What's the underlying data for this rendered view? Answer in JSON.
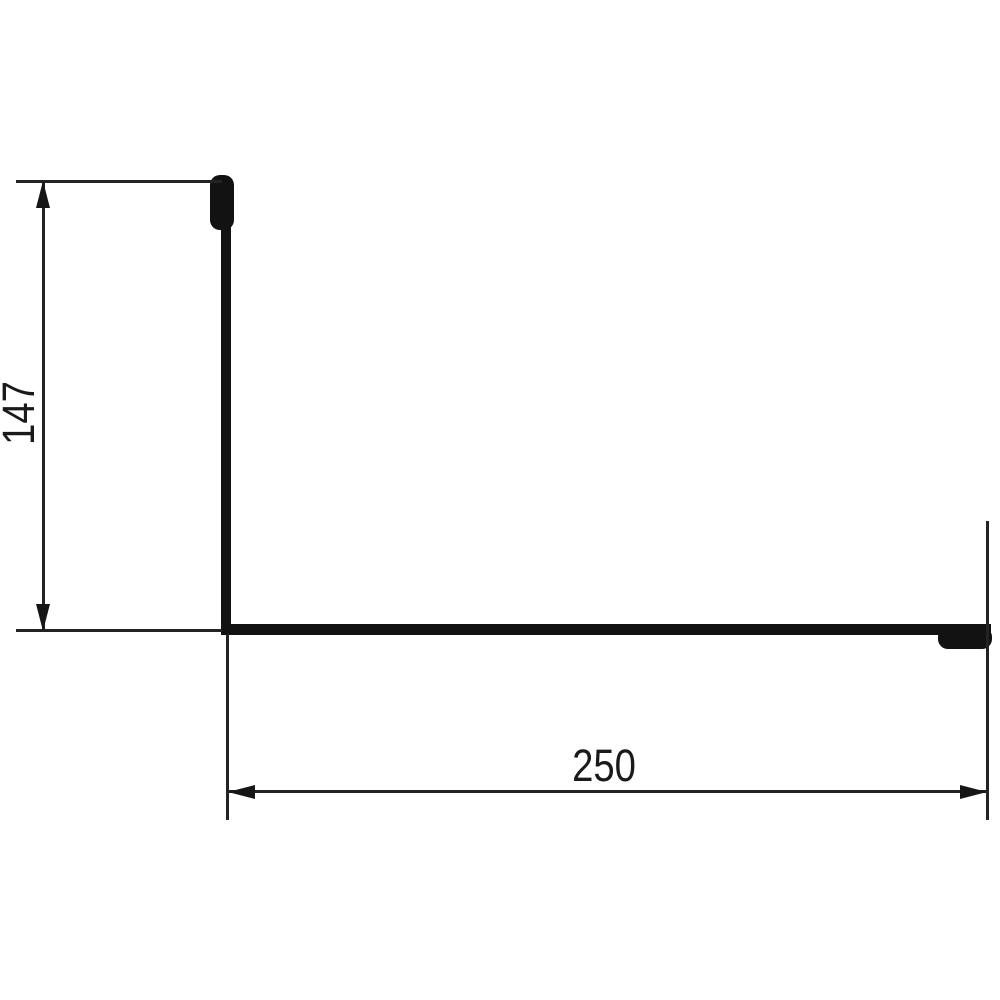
{
  "drawing": {
    "description": "Cross-section of an L-shaped sheet metal flashing profile with hemmed (folded) edges at both ends, annotated with two dimensions",
    "background_color": "#ffffff",
    "profile_line_color": "#121212",
    "dimension_line_color": "#232323",
    "dimensions": {
      "height": {
        "value": "147"
      },
      "width": {
        "value": "250"
      }
    }
  }
}
